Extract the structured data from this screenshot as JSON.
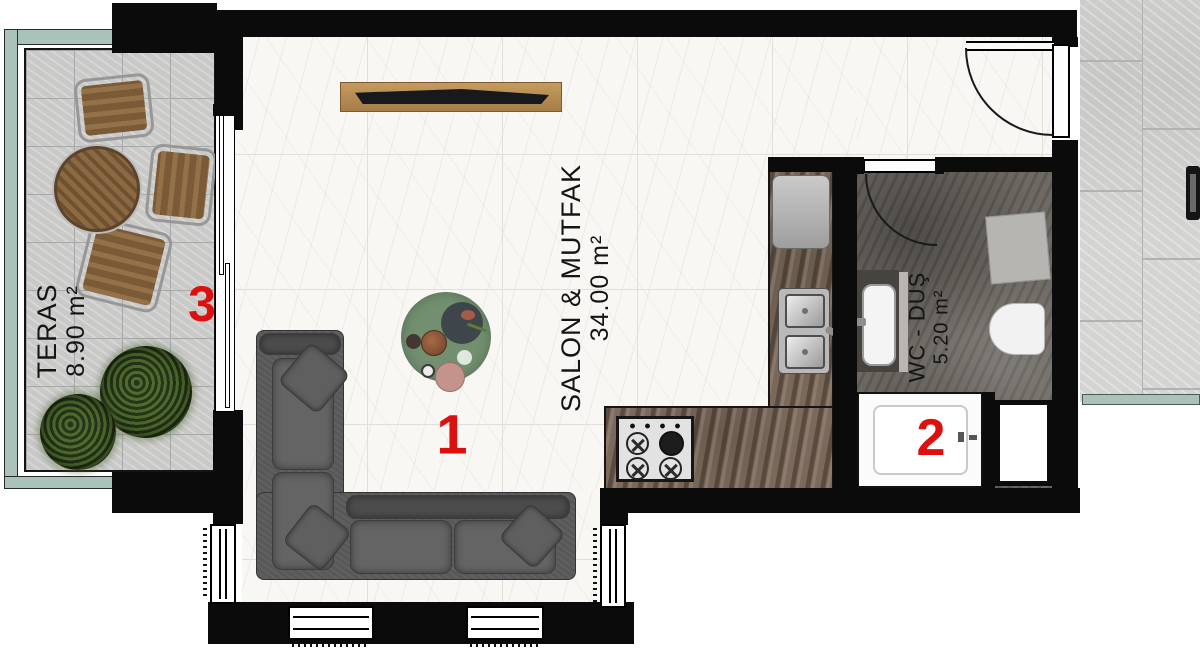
{
  "rooms": {
    "salon": {
      "name": "SALON & MUTFAK",
      "area": "34.00 m²",
      "number": "1"
    },
    "wc": {
      "name": "WC - DUŞ",
      "area": "5.20 m²",
      "number": "2"
    },
    "teras": {
      "name": "TERAS",
      "area": "8.90 m²",
      "number": "3"
    }
  },
  "colors": {
    "wall": "#0b0b0b",
    "label_number_red": "#dd1010",
    "railing_teal": "#a9c2ba",
    "coffee_table_green": "#72906f",
    "marble_floor": "#f8f7f4",
    "wc_floor": "#6e6963",
    "counter_marble": "#7b6a5c"
  }
}
